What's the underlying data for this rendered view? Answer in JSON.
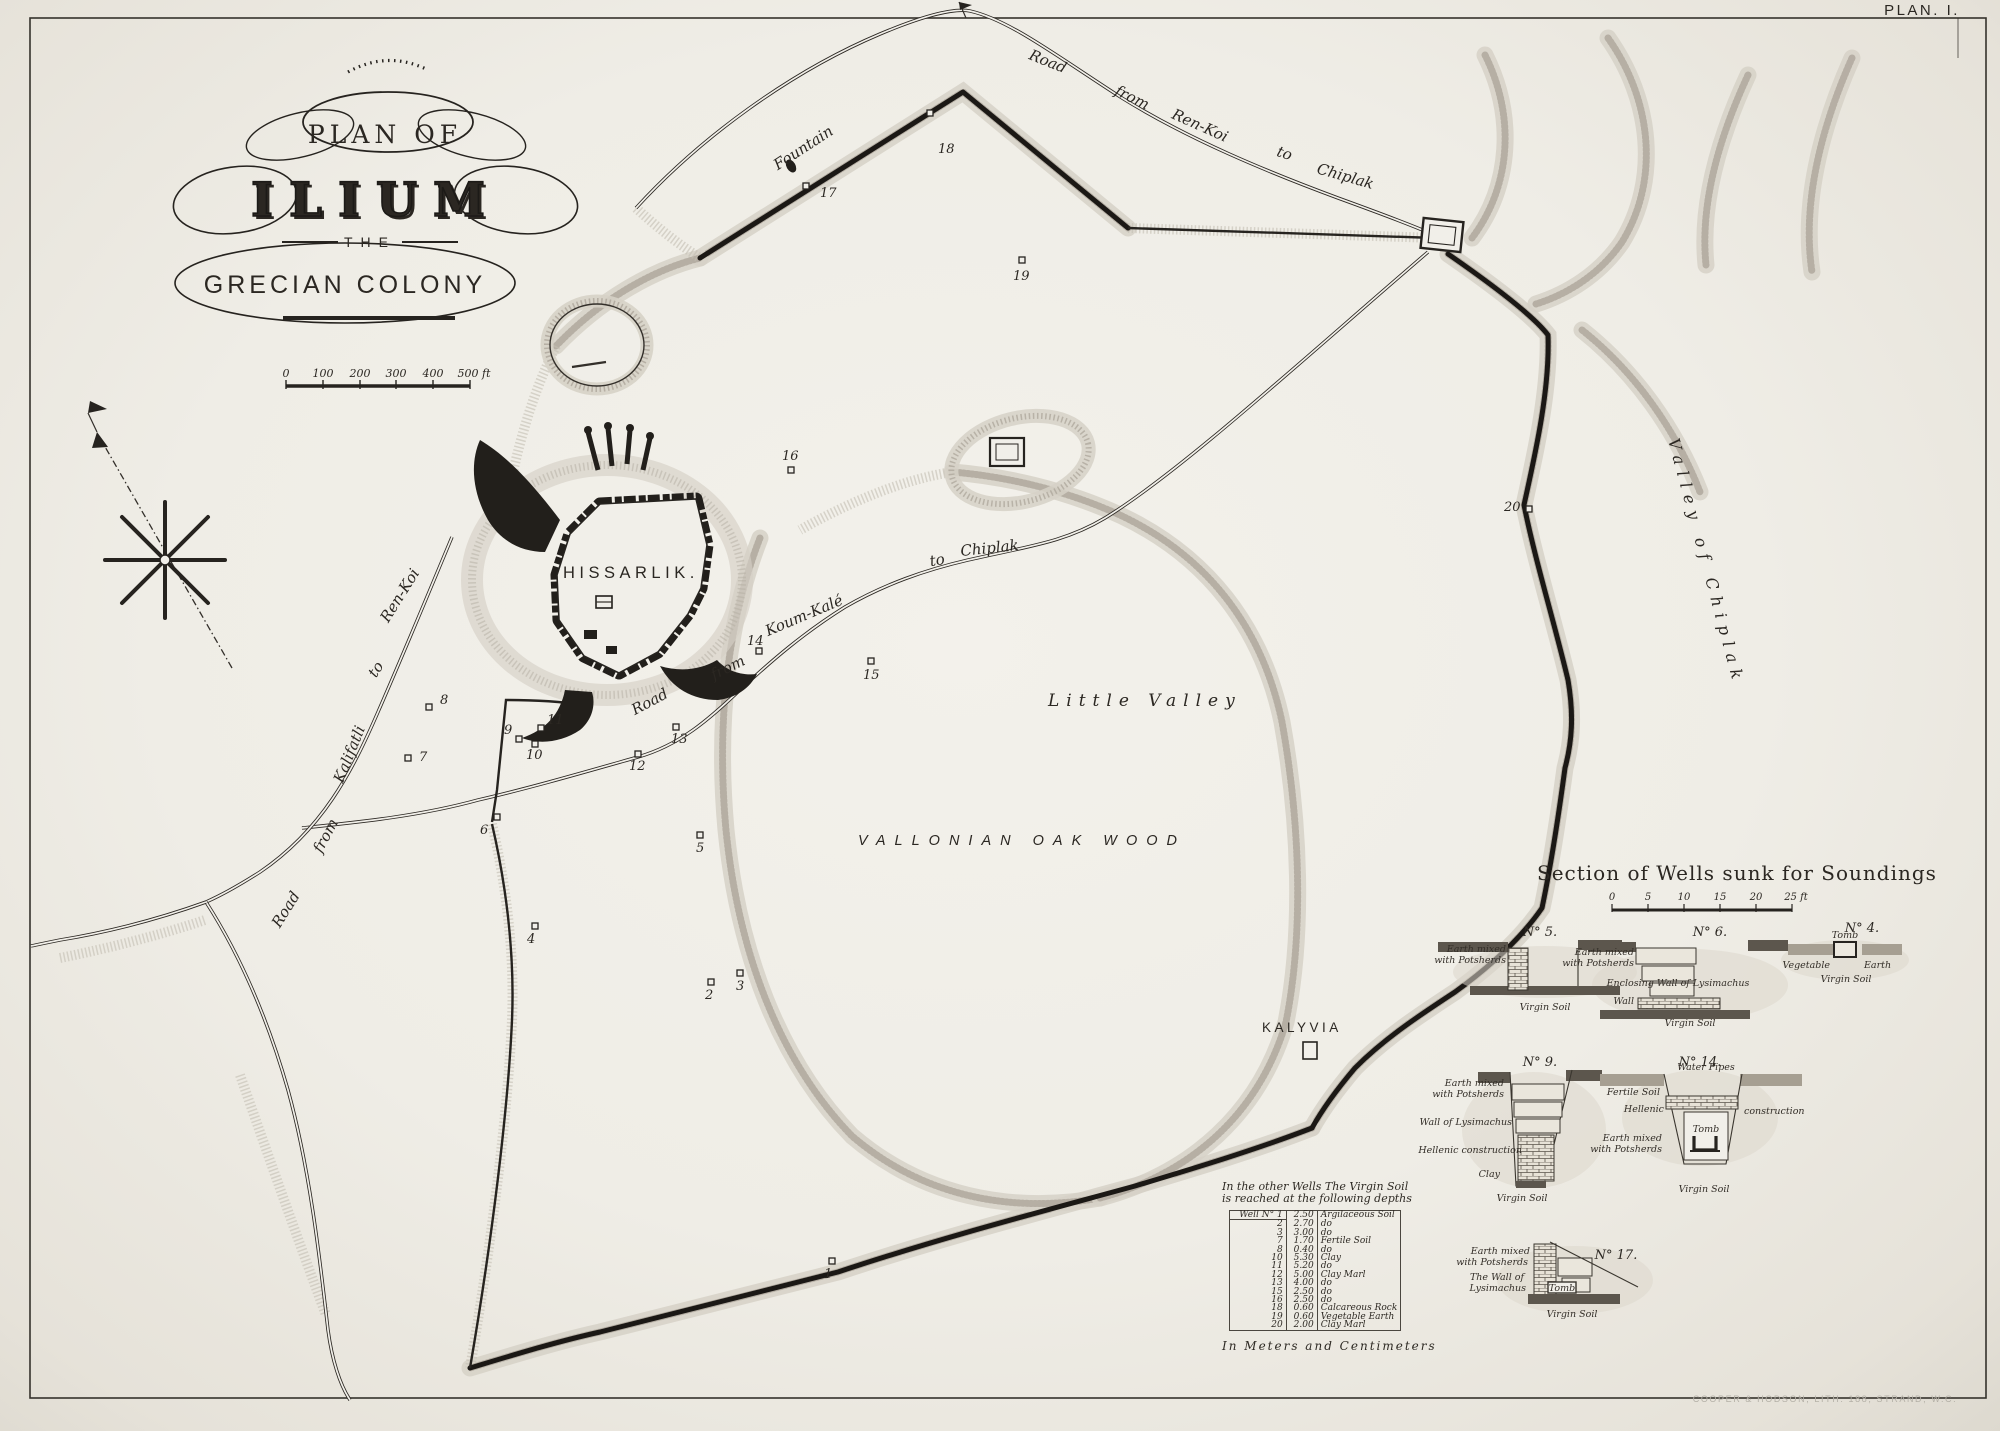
{
  "page": {
    "plate": "PLAN. I.",
    "imprint": "COOPER & HODSON, LITH. 188, STRAND, W.C."
  },
  "title": {
    "l1": "PLAN OF",
    "l2": "ILIUM",
    "l3": "THE",
    "l4": "GRECIAN COLONY"
  },
  "scale": {
    "ticks": [
      "0",
      "100",
      "200",
      "300",
      "400",
      "500 ft"
    ]
  },
  "map": {
    "hissarlik": "HISSARLIK.",
    "fountain": "Fountain",
    "kalyvia": "KALYVIA",
    "little_valley": "Little  Valley",
    "oak_wood": "VALLONIAN   OAK   WOOD",
    "valley_chiplak": "Valley  of  Chiplak",
    "roads": {
      "top": [
        "Road",
        "from",
        "Ren-Koi",
        "to",
        "Chiplak"
      ],
      "mid": [
        "Road",
        "from",
        "Koum-Kalé",
        "to",
        "Chiplak"
      ],
      "left": [
        "Road",
        "from",
        "Kalifatli",
        "to",
        "Ren-Koi"
      ]
    },
    "markers": [
      {
        "n": "1",
        "mx": 832,
        "my": 1261,
        "lx": 824,
        "ly": 1278
      },
      {
        "n": "2",
        "mx": 711,
        "my": 982,
        "lx": 705,
        "ly": 999
      },
      {
        "n": "3",
        "mx": 740,
        "my": 973,
        "lx": 736,
        "ly": 990
      },
      {
        "n": "4",
        "mx": 535,
        "my": 926,
        "lx": 527,
        "ly": 943
      },
      {
        "n": "5",
        "mx": 700,
        "my": 835,
        "lx": 696,
        "ly": 852
      },
      {
        "n": "6",
        "mx": 497,
        "my": 817,
        "lx": 480,
        "ly": 834
      },
      {
        "n": "7",
        "mx": 408,
        "my": 758,
        "lx": 419,
        "ly": 761
      },
      {
        "n": "8",
        "mx": 429,
        "my": 707,
        "lx": 440,
        "ly": 704
      },
      {
        "n": "9",
        "mx": 519,
        "my": 739,
        "lx": 504,
        "ly": 734
      },
      {
        "n": "10",
        "mx": 535,
        "my": 744,
        "lx": 526,
        "ly": 759
      },
      {
        "n": "11",
        "mx": 541,
        "my": 728,
        "lx": 547,
        "ly": 724
      },
      {
        "n": "12",
        "mx": 638,
        "my": 754,
        "lx": 629,
        "ly": 770
      },
      {
        "n": "13",
        "mx": 676,
        "my": 727,
        "lx": 671,
        "ly": 743
      },
      {
        "n": "14",
        "mx": 759,
        "my": 651,
        "lx": 747,
        "ly": 645
      },
      {
        "n": "15",
        "mx": 871,
        "my": 661,
        "lx": 863,
        "ly": 679
      },
      {
        "n": "16",
        "mx": 791,
        "my": 470,
        "lx": 782,
        "ly": 460
      },
      {
        "n": "17",
        "mx": 806,
        "my": 186,
        "lx": 820,
        "ly": 197
      },
      {
        "n": "18",
        "mx": 930,
        "my": 113,
        "lx": 938,
        "ly": 153
      },
      {
        "n": "19",
        "mx": 1022,
        "my": 260,
        "lx": 1013,
        "ly": 280
      },
      {
        "n": "20",
        "mx": 1529,
        "my": 509,
        "lx": 1504,
        "ly": 511
      }
    ]
  },
  "sections": {
    "title": "Section of Wells sunk for Soundings",
    "scale_ticks": [
      "0",
      "5",
      "10",
      "15",
      "20",
      "25 ft"
    ],
    "w5": {
      "no": "N° 5.",
      "earth": "Earth mixed",
      "earth2": "with Potsherds",
      "virgin": "Virgin Soil"
    },
    "w6": {
      "no": "N° 6.",
      "earth": "Earth mixed",
      "earth2": "with Potsherds",
      "wall_lys": "Enclosing Wall of Lysimachus",
      "wall": "Wall",
      "virgin": "Virgin Soil"
    },
    "w4": {
      "no": "N° 4.",
      "veg": "Vegetable",
      "tomb": "Tomb",
      "earth": "Earth",
      "virgin": "Virgin Soil"
    },
    "w9": {
      "no": "N° 9.",
      "earth": "Earth mixed",
      "earth2": "with Potsherds",
      "wall_lys": "Wall of Lysimachus",
      "hellenic": "Hellenic construction",
      "clay": "Clay",
      "virgin": "Virgin Soil"
    },
    "w14": {
      "no": "N° 14.",
      "fertile": "Fertile Soil",
      "pipes": "Water Pipes",
      "hell1": "Hellenic",
      "hell2": "construction",
      "earth": "Earth mixed",
      "earth2": "with Potsherds",
      "tomb": "Tomb",
      "virgin": "Virgin Soil"
    },
    "w17": {
      "no": "N° 17.",
      "earth": "Earth mixed",
      "earth2": "with Potsherds",
      "wall1": "The Wall of",
      "wall2": "Lysimachus",
      "tomb": "Tomb",
      "virgin": "Virgin Soil"
    }
  },
  "table": {
    "h1": "In the other Wells The Virgin Soil",
    "h2": "is reached at the following depths",
    "rows": [
      [
        "Well N° 1",
        "2.50",
        "Argilaceous Soil"
      ],
      [
        "2",
        "2.70",
        "do"
      ],
      [
        "3",
        "3.00",
        "do"
      ],
      [
        "7",
        "1.70",
        "Fertile Soil"
      ],
      [
        "8",
        "0.40",
        "do"
      ],
      [
        "10",
        "5.30",
        "Clay"
      ],
      [
        "11",
        "5.20",
        "do"
      ],
      [
        "12",
        "5.00",
        "Clay Marl"
      ],
      [
        "13",
        "4.00",
        "do"
      ],
      [
        "15",
        "2.50",
        "do"
      ],
      [
        "16",
        "2.50",
        "do"
      ],
      [
        "18",
        "0.60",
        "Calcareous Rock"
      ],
      [
        "19",
        "0.60",
        "Vegetable Earth"
      ],
      [
        "20",
        "2.00",
        "Clay Marl"
      ]
    ],
    "footer": "In Meters and Centimeters"
  }
}
